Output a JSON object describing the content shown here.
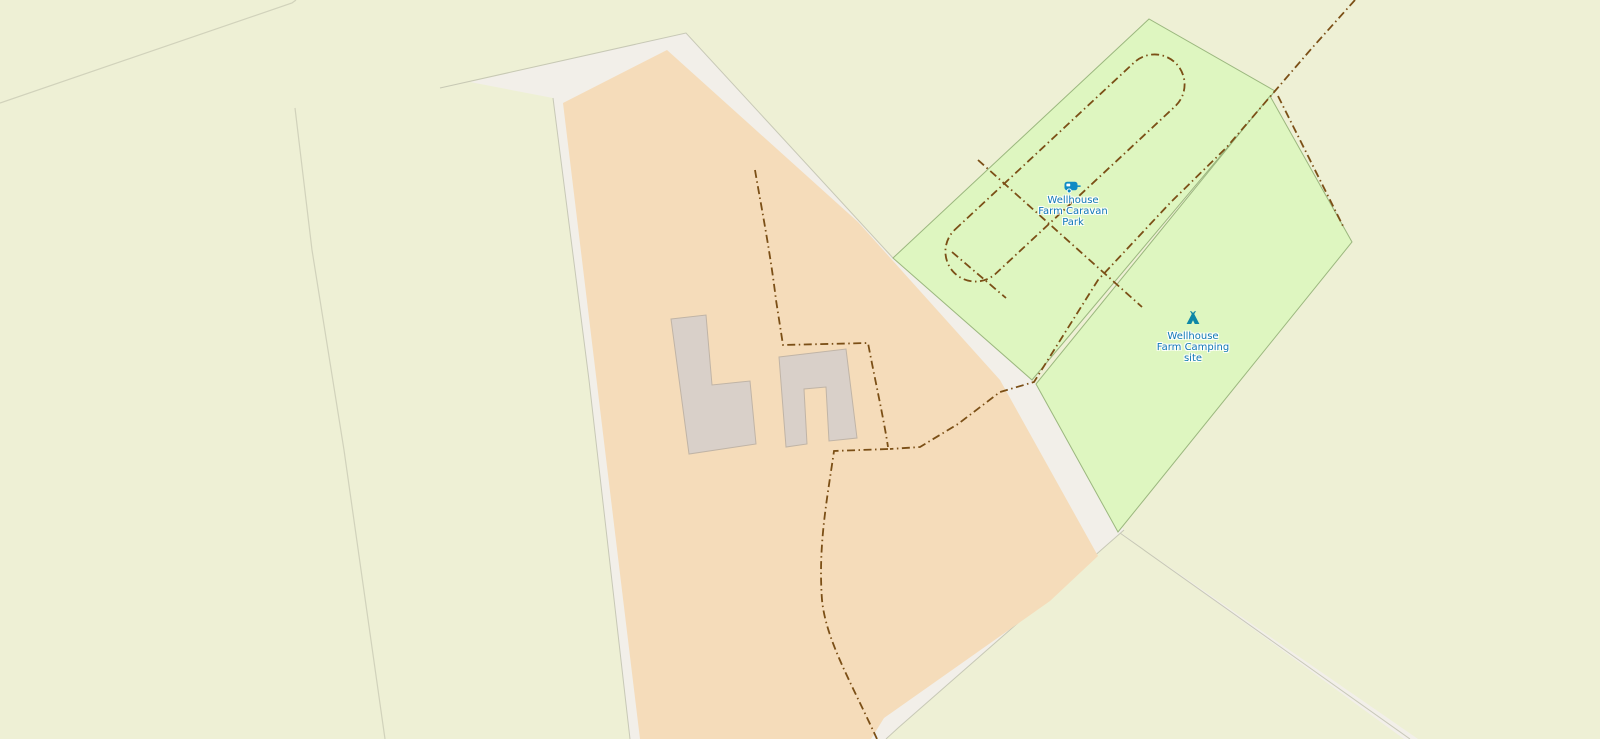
{
  "map": {
    "style": "openstreetmap-carto",
    "labels": [
      {
        "name": "Wellhouse Farm Caravan Park",
        "lines": [
          "Wellhouse",
          "Farm Caravan",
          "Park"
        ],
        "icon": "caravan-icon"
      },
      {
        "name": "Wellhouse Farm Camping site",
        "lines": [
          "Wellhouse",
          "Farm Camping",
          "site"
        ],
        "icon": "tent-icon"
      }
    ],
    "features": {
      "farmyard": "large tan farmyard parcel with two farm buildings",
      "caravan_park": "green caravan site with dashed track loop",
      "camping_site": "green camp site parcel",
      "tracks": "brown dash-dot farm tracks crossing the parcels"
    },
    "colors": {
      "farmland": "#eef0d5",
      "track_background": "#f2efe9",
      "farmyard": "#f5dcba",
      "campsite_fill": "#def6c0",
      "campsite_border": "#9bb77e",
      "building_fill": "#d9d0c9",
      "building_border": "#c0b4a6",
      "parcel_line": "#c9cab4",
      "corridor_edge": "#b9bba8",
      "track_dash": "#7b4f16",
      "label_text": "#0f76b8",
      "caravan_icon": "#0e8bc4",
      "tent_icon": "#0e87a6"
    }
  }
}
